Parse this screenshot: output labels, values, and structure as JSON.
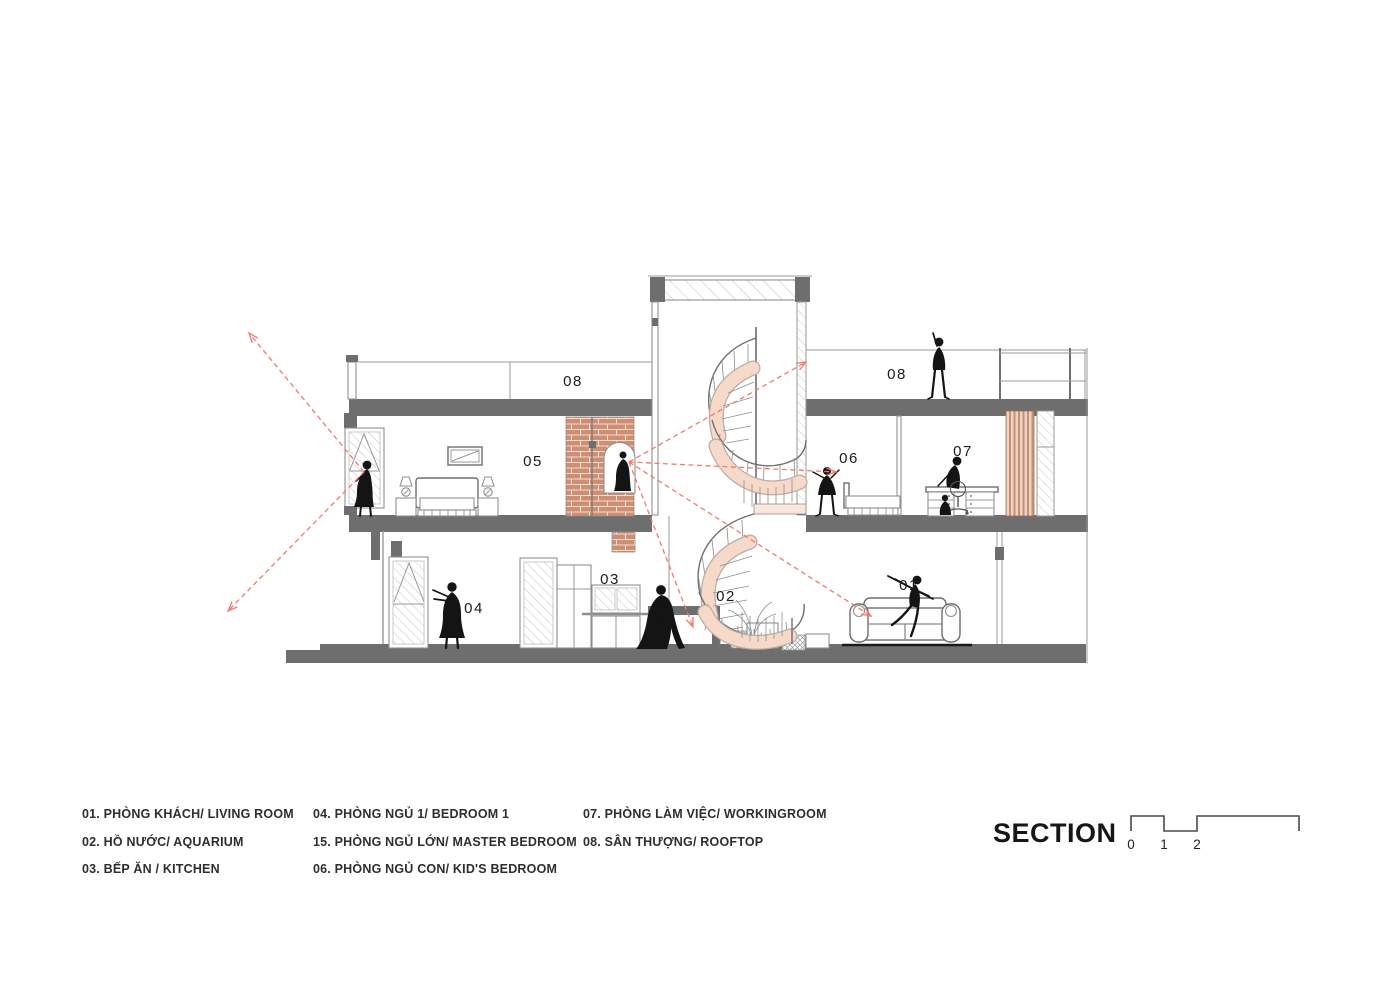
{
  "title": {
    "label": "SECTION"
  },
  "scale_bar": {
    "ticks": [
      "0",
      "1",
      "2",
      "5"
    ]
  },
  "legend": {
    "col1": [
      {
        "label": "01. PHÒNG KHÁCH/ LIVING ROOM"
      },
      {
        "label": "02. HỒ NƯỚC/ AQUARIUM"
      },
      {
        "label": "03. BẾP ĂN / KITCHEN"
      }
    ],
    "col2": [
      {
        "label": "04. PHÒNG NGỦ 1/ BEDROOM 1"
      },
      {
        "label": "15. PHÒNG NGỦ LỚN/ MASTER BEDROOM"
      },
      {
        "label": "06. PHÒNG NGỦ CON/ KID'S BEDROOM"
      }
    ],
    "col3": [
      {
        "label": "07. PHÒNG LÀM VIỆC/ WORKINGROOM"
      },
      {
        "label": "08. SÂN THƯỢNG/ ROOFTOP"
      }
    ]
  },
  "drawing": {
    "room_labels": {
      "r01": "01",
      "r02": "02",
      "r03": "03",
      "r04": "04",
      "r05": "05",
      "r06": "06",
      "r07": "07",
      "r08_left": "08",
      "r08_right": "08"
    }
  },
  "colors": {
    "slab": "#6e6e6e",
    "line": "#9a9a9a",
    "brick": "#cf8d72",
    "brick_mortar": "#f0ddd3",
    "stair": "#f6d9c8",
    "stair_edge": "#b9ada5",
    "louver": "#c98f73",
    "louver_bg": "#ecd4c5",
    "sightline": "#f2796b",
    "figure": "#141414"
  }
}
